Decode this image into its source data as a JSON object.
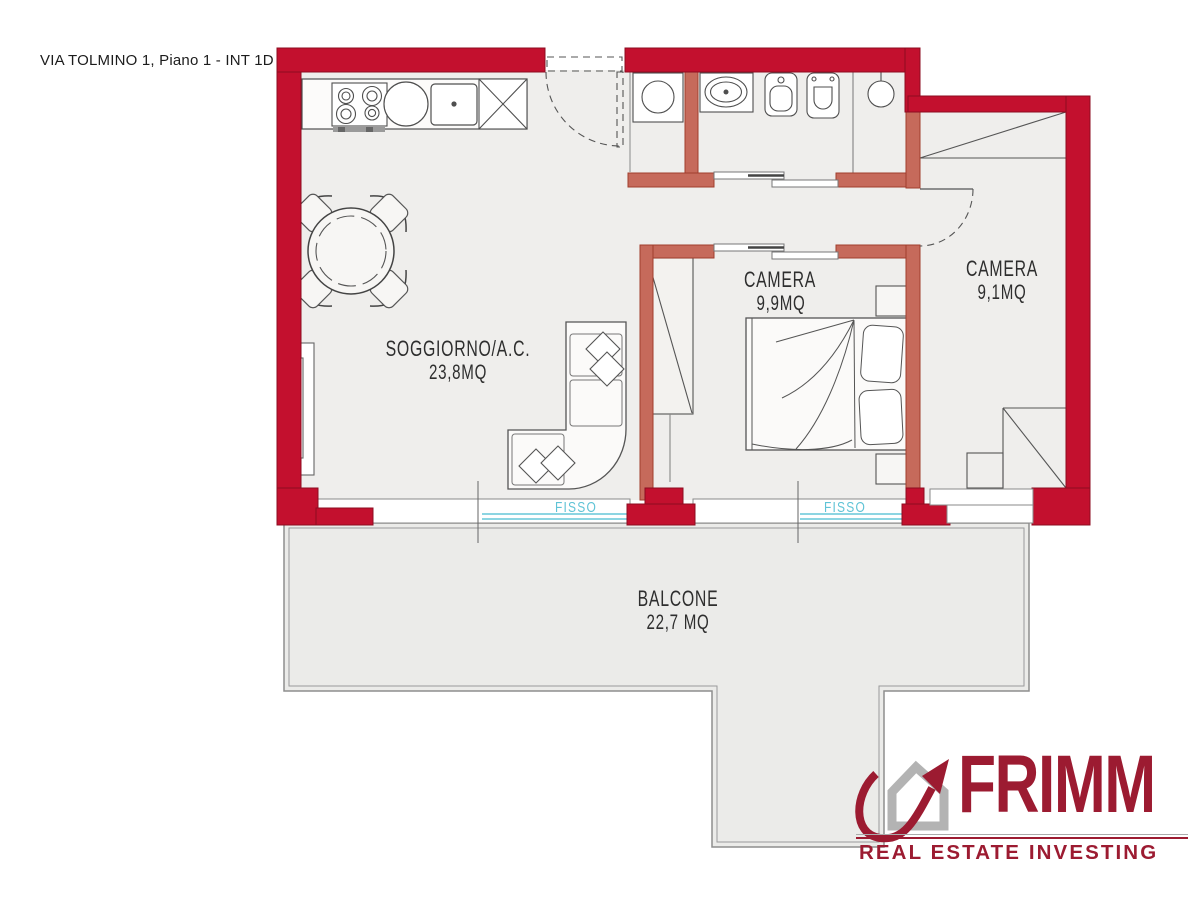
{
  "title": "VIA TOLMINO 1, Piano 1 - INT 1D",
  "plan": {
    "rooms": [
      {
        "id": "soggiorno",
        "name": "SOGGIORNO/A.C.",
        "area": "23,8MQ"
      },
      {
        "id": "camera-1",
        "name": "CAMERA",
        "area": "9,9MQ"
      },
      {
        "id": "camera-2",
        "name": "CAMERA",
        "area": "9,1MQ"
      },
      {
        "id": "balcone",
        "name": "BALCONE",
        "area": "22,7 MQ"
      }
    ],
    "window_labels": [
      {
        "id": "fisso-soggiorno",
        "text": "FISSO"
      },
      {
        "id": "fisso-camera",
        "text": "FISSO"
      }
    ]
  },
  "logo": {
    "brand": "FRIMM",
    "tagline": "REAL ESTATE INVESTING"
  },
  "colors": {
    "outer_wall": "#c3102e",
    "inner_wall": "#c66a5b",
    "floor": "#efeeec",
    "balcony": "#ebebe9",
    "fisso_text": "#5fc3d6",
    "furniture_line": "#4f4f4f",
    "logo_red": "#9c1b31",
    "logo_grey": "#b3b3b3"
  }
}
